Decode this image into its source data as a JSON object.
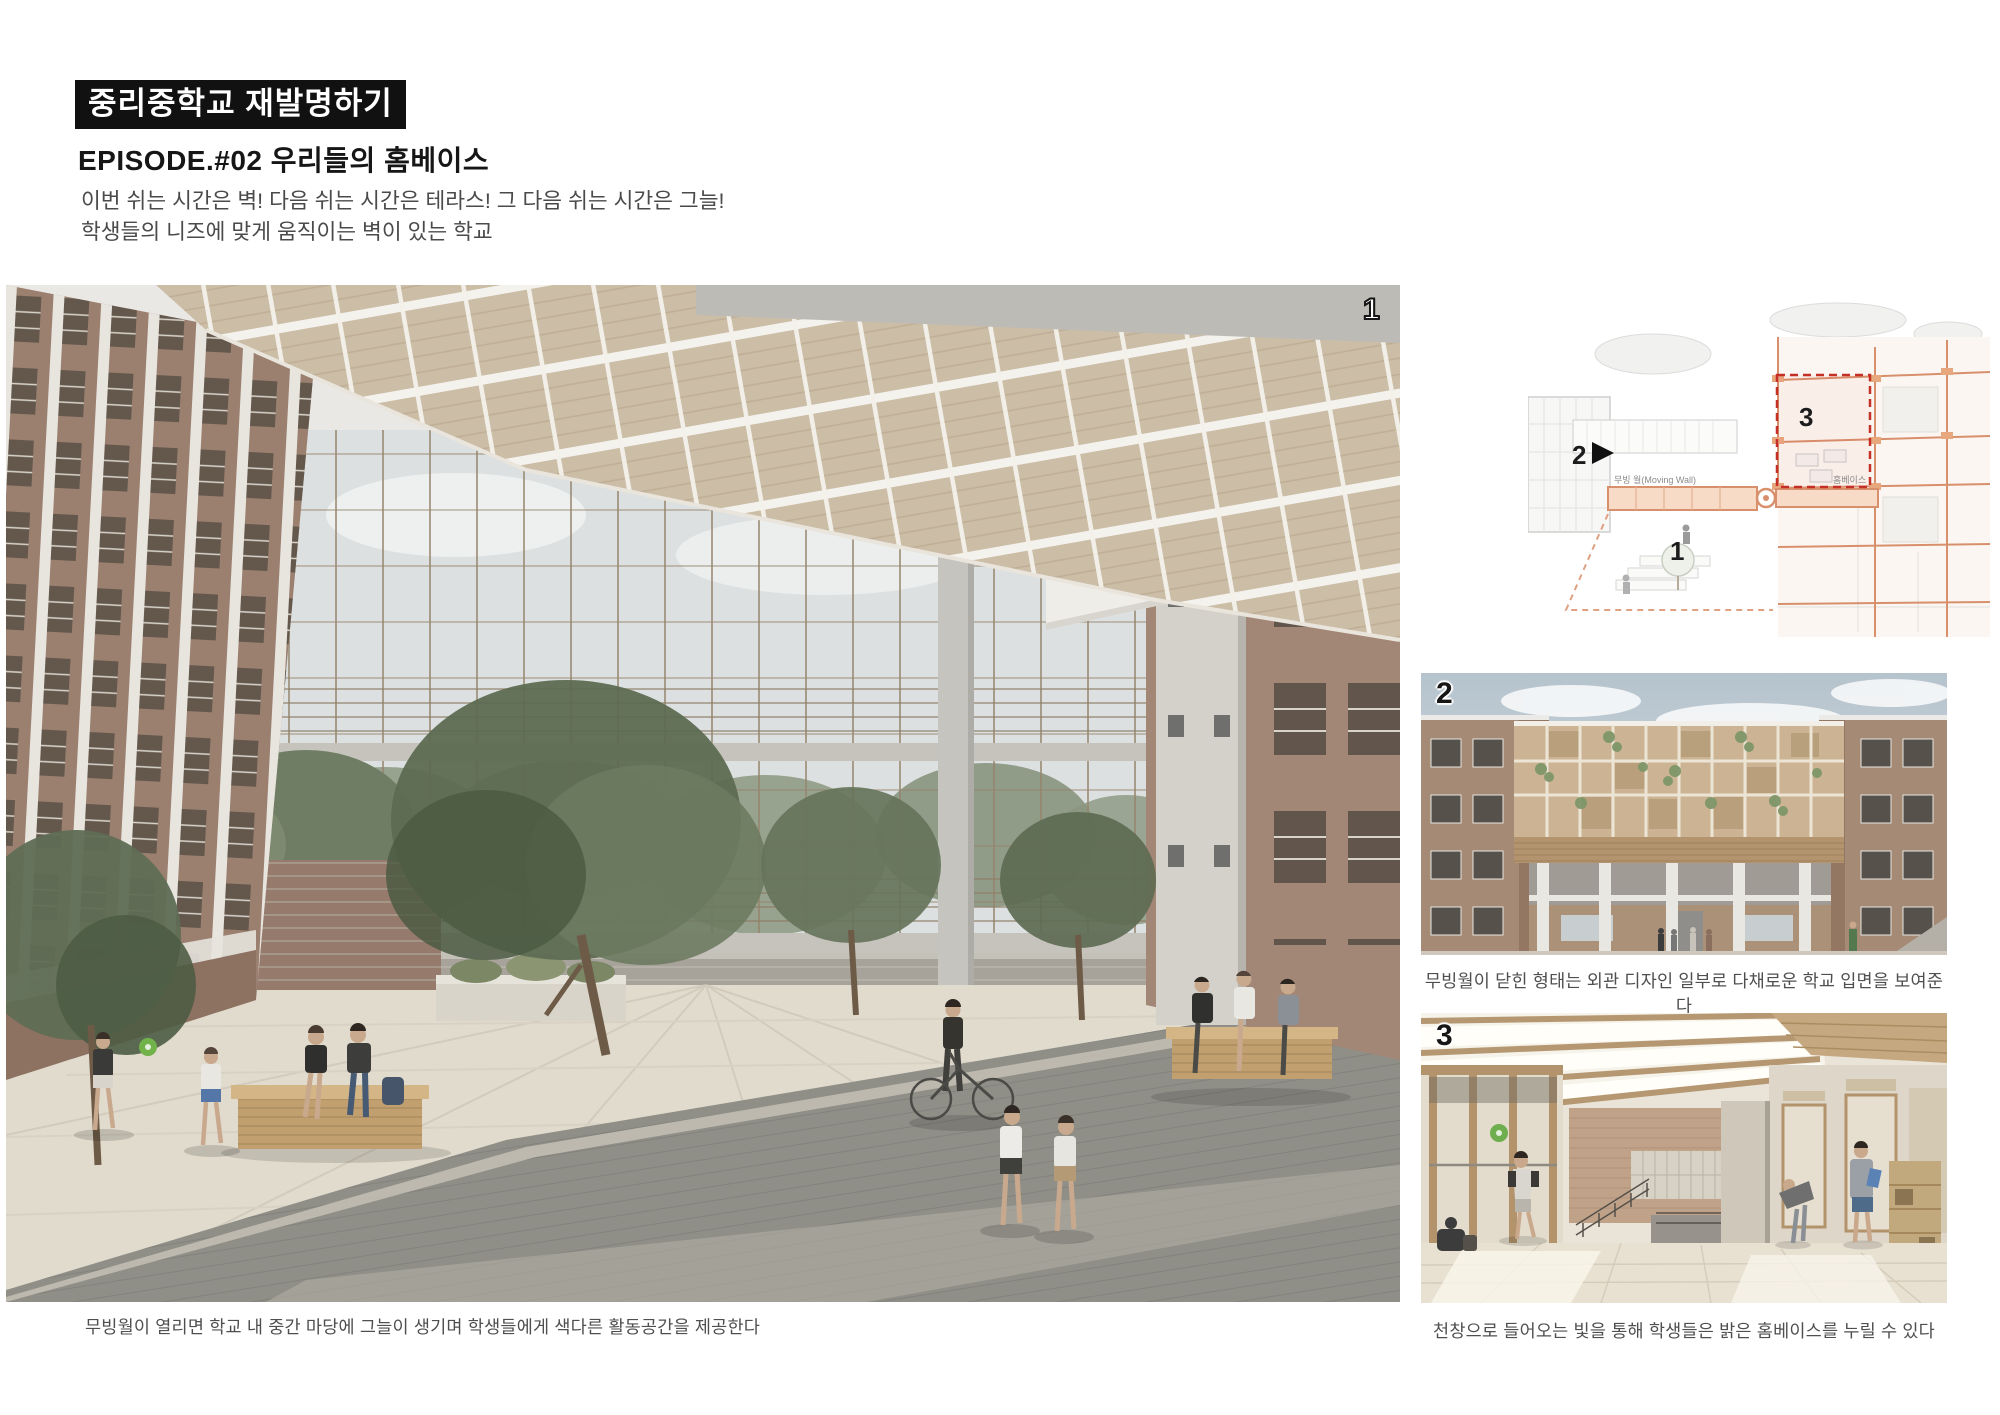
{
  "header": {
    "title": "중리중학교 재발명하기",
    "subtitle": "EPISODE.#02 우리들의 홈베이스",
    "description": [
      "이번 쉬는 시간은 벽! 다음 쉬는 시간은 테라스! 그 다음 쉬는 시간은 그늘!",
      "학생들의 니즈에 맞게 움직이는 벽이 있는 학교"
    ]
  },
  "figures": {
    "main": {
      "number": "1",
      "caption": "무빙월이 열리면 학교 내 중간 마당에 그늘이 생기며 학생들에게 색다른 활동공간을 제공한다"
    },
    "diagram": {
      "label_courtyard": "1",
      "label_facade": "2",
      "label_homebase": "3",
      "annotation_moving_wall": "무빙 월(Moving Wall)",
      "annotation_homebase": "홈베이스"
    },
    "facade": {
      "number": "2",
      "caption": "무빙월이 닫힌 형태는 외관 디자인 일부로 다채로운 학교 입면을 보여준다"
    },
    "interior": {
      "number": "3",
      "caption": "천창으로 들어오는 빛을 통해 학생들은 밝은 홈베이스를 누릴 수 있다"
    }
  },
  "colors": {
    "title_bg": "#111111",
    "title_fg": "#ffffff",
    "caption": "#4f4f4f",
    "accent_orange": "#d8906c",
    "accent_red": "#c43026",
    "canopy_wood": "#ccbda7",
    "brick": "#9b8070",
    "green_ball": "#72b24a"
  }
}
